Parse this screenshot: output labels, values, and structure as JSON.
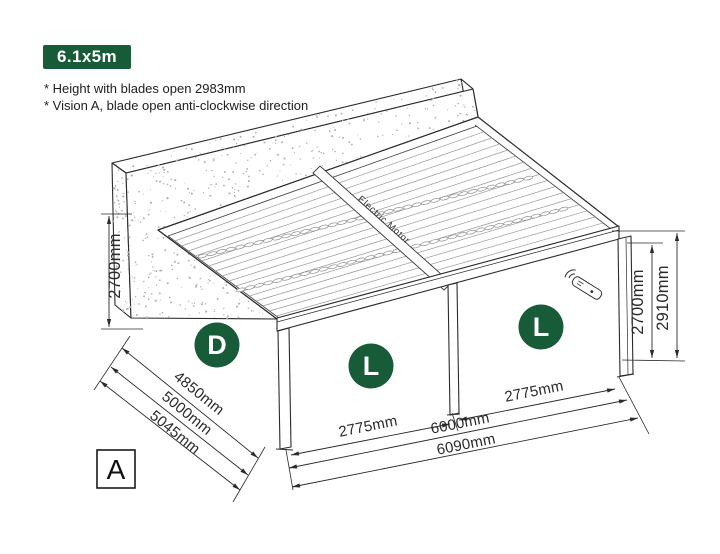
{
  "badge": {
    "label": "6.1x5m"
  },
  "notes": {
    "line1": "* Height with blades open 2983mm",
    "line2": "* Vision A, blade open anti-clockwise direction"
  },
  "diagram": {
    "motor_label": "Electric Motor",
    "view_label": "A",
    "zones": {
      "left_side": "D",
      "bay_left": "L",
      "bay_right": "L"
    },
    "dims": {
      "left_height": "2700mm",
      "depth_1": "4850mm",
      "depth_2": "5000mm",
      "depth_3": "5045mm",
      "bay_left_width": "2775mm",
      "bay_right_width": "2775mm",
      "width_inner": "6000mm",
      "width_outer": "6090mm",
      "right_post_height": "2700mm",
      "right_total_height": "2910mm"
    }
  },
  "colors": {
    "accent_green": "#175B38",
    "line": "#2b2b2b"
  }
}
